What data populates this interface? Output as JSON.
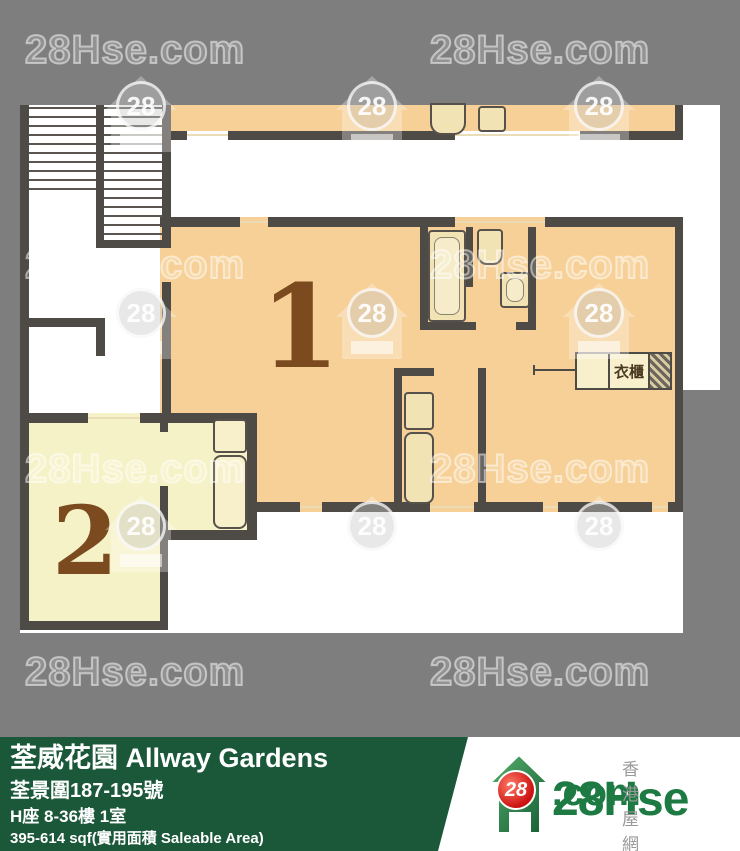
{
  "watermark": {
    "text": "28Hse.com",
    "badge": "28"
  },
  "plan": {
    "unit1_label": "1",
    "unit2_label": "2",
    "wardrobe_label": "衣櫃"
  },
  "footer": {
    "building": "荃威花園 Allway Gardens",
    "address": "荃景圍187-195號",
    "block_floor": "H座 8-36樓 1室",
    "area": "395-614 sqf(實用面積 Saleable Area)"
  },
  "logo": {
    "badge": "28",
    "site_name": "28Hse",
    "site_tld": ".com",
    "tagline": "香港屋網"
  },
  "colors": {
    "background": "#7e7e7e",
    "unit1_fill": "#f6d096",
    "unit2_fill": "#f6f2c8",
    "wall": "#4e4a46",
    "label_brown": "#7b4a1f",
    "footer_green": "#1b5839",
    "logo_green": "#1e7a43",
    "badge_red": "#cc1111"
  }
}
